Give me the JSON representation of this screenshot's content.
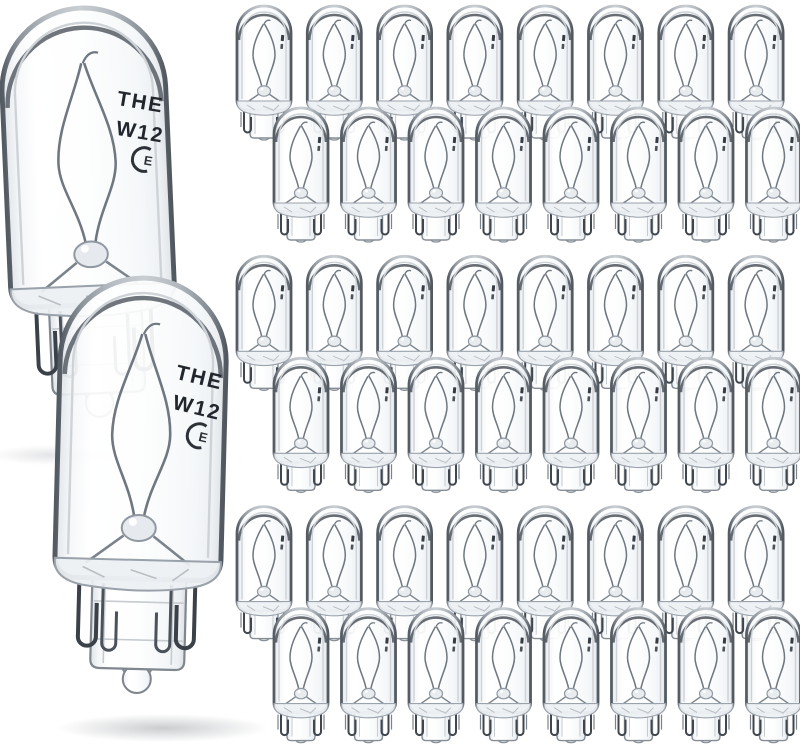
{
  "image": {
    "type": "product-photo",
    "subject": "Clear glass T10 wedge-base miniature incandescent bulbs on white background",
    "background_color": "#ffffff"
  },
  "product": {
    "pack": {
      "large_foreground_bulbs": 2,
      "small_bulb_rows": 6,
      "bulbs_per_row": 8,
      "small_bulbs_total": 48,
      "total_bulbs": 50
    },
    "glass_marking": {
      "line1": "THE",
      "line2": "W12",
      "certification_mark": "E"
    }
  },
  "colors": {
    "background": "#ffffff",
    "glass_edge_dark": "#4d545c",
    "glass_edge_mid": "#8d949b",
    "glass_edge_light": "#c9ced3",
    "glass_fill_highlight": "#ffffff",
    "glass_fill_shade": "#e7ebee",
    "filament_wire": "#6f7781",
    "base_wire_dark": "#3a4149",
    "marking_text": "#22272d",
    "shadow": "#646b72"
  },
  "layout": {
    "grid": {
      "bands": 3,
      "cols": 8,
      "band_dy": 250.3,
      "back": {
        "x0": 233,
        "y0": 2,
        "dx": 70.3
      },
      "front": {
        "x0": 270,
        "y0": 104,
        "dx": 67.5
      },
      "bulb_w": 62,
      "bulb_h": 144
    },
    "large_bulbs": [
      {
        "x": -2,
        "y": 2,
        "w": 177,
        "h": 426,
        "rotate": -2.5,
        "cx": 86,
        "cy": 150
      },
      {
        "x": 51,
        "y": 272,
        "w": 178,
        "h": 432,
        "rotate": 1.5,
        "cx": 140,
        "cy": 480
      }
    ],
    "shadows": [
      {
        "cx": 52,
        "cy": 455,
        "rx": 62,
        "ry": 10,
        "opacity": 0.45
      },
      {
        "cx": 163,
        "cy": 728,
        "rx": 106,
        "ry": 14,
        "opacity": 0.85
      }
    ]
  }
}
